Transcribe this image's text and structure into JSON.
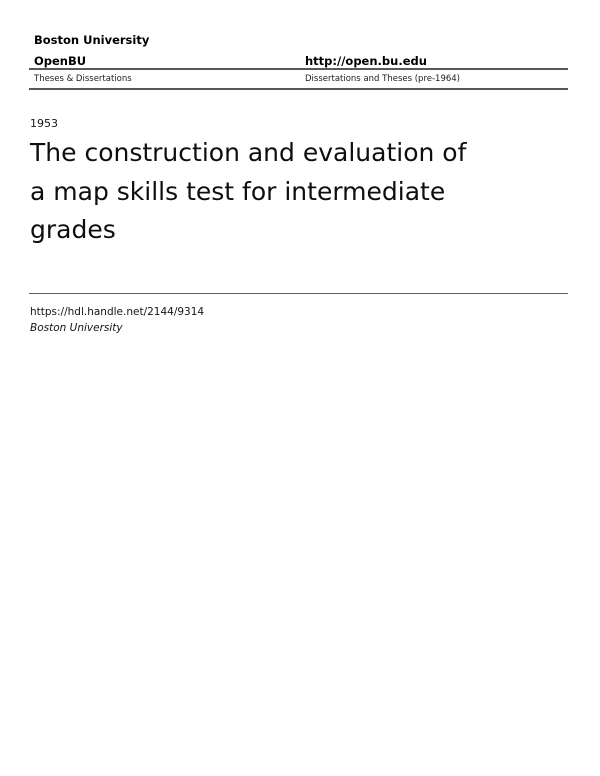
{
  "theme": {
    "background": "#ffffff",
    "text": "#000000",
    "rule": "#585858"
  },
  "header": {
    "institution": "Boston University",
    "repository": "OpenBU",
    "repository_url": "http://open.bu.edu",
    "collection_left": "Theses & Dissertations",
    "collection_right": "Dissertations and Theses (pre-1964)"
  },
  "document": {
    "year": "1953",
    "title": "The construction and evaluation of a map skills test for intermediate grades",
    "title_lines": [
      "The construction and evaluation of",
      "a map skills test for intermediate",
      "grades"
    ]
  },
  "footer": {
    "handle_url": "https://hdl.handle.net/2144/9314",
    "publisher": "Boston University"
  }
}
